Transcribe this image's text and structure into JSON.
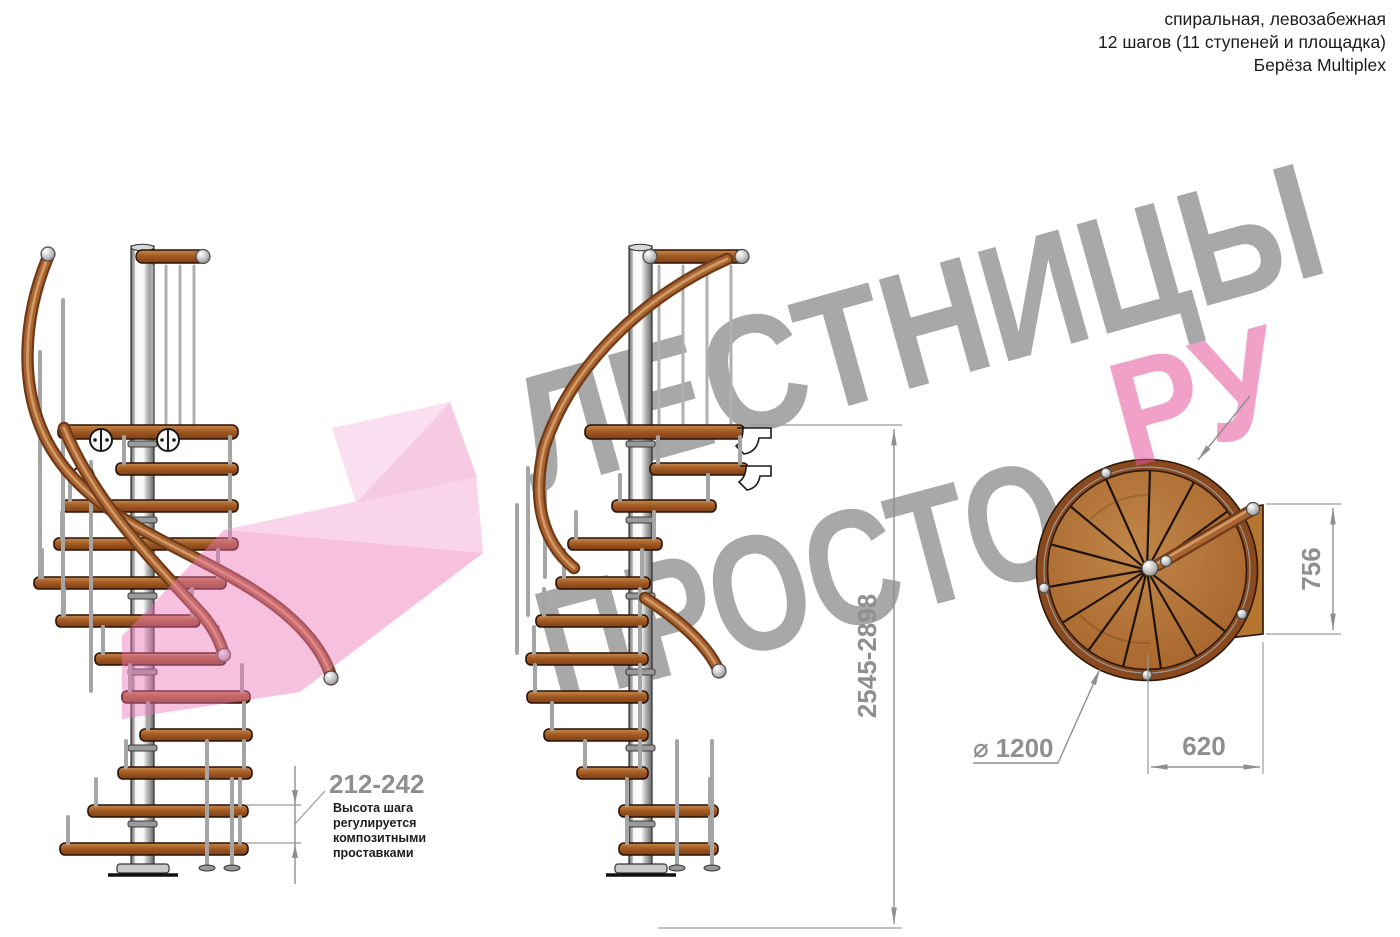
{
  "header": {
    "line1": "спиральная, левозабежная",
    "line2": "12 шагов (11 ступеней и площадка)",
    "line3": "Берёза Multiplex"
  },
  "watermark": {
    "word1": "ЛЕСТНИЦЫ",
    "word2": "ПРОСТО",
    "word3": "РУ",
    "gray_color": "#a8a8a8",
    "pink_color": "#e7559c",
    "logo_pink_fill": "#ec74b8"
  },
  "dimensions": {
    "step_height": {
      "value": "212-242",
      "note_lines": [
        "Высота шага",
        "регулируется",
        "композитными",
        "проставками"
      ]
    },
    "total_height": {
      "value": "2545-2898"
    },
    "landing_depth": {
      "value": "756"
    },
    "landing_width": {
      "value": "620"
    },
    "diameter": {
      "symbol": "⌀",
      "value": "1200"
    }
  },
  "colors": {
    "wood": "#a96432",
    "wood_dark": "#7c3f13",
    "wood_light": "#c98a4e",
    "metal": "#c9c9c9",
    "dimension_gray": "#8f8f8f",
    "note_black": "#1d1d1d"
  }
}
